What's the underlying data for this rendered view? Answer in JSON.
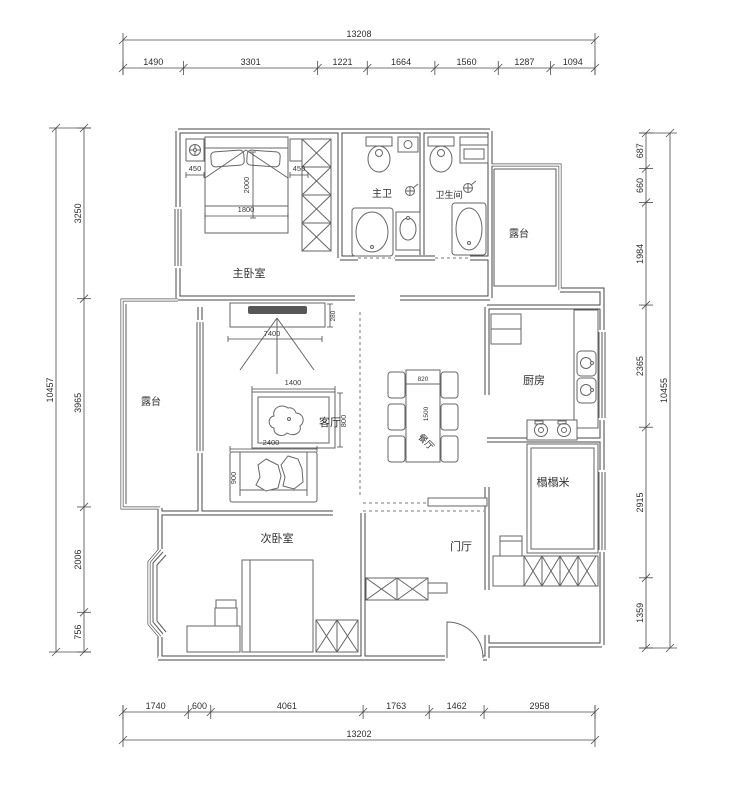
{
  "drawing": {
    "rooms": {
      "master_bedroom": "主卧室",
      "master_bath": "主卫",
      "bathroom": "卫生间",
      "terrace_top": "露台",
      "terrace_left": "露台",
      "living_room": "客厅",
      "dining_room": "餐厅",
      "kitchen": "厨房",
      "tatami_room": "榻榻米",
      "second_bedroom": "次卧室",
      "foyer": "门厅"
    },
    "furniture_dims": {
      "nightstand_left": "450",
      "nightstand_right": "450",
      "bed_width": "1800",
      "bed_length": "2000",
      "tv_wall_width": "7400",
      "tv_niche_depth": "280",
      "coffee_table_width": "1400",
      "coffee_table_depth": "800",
      "sofa_width": "2400",
      "sofa_depth": "900",
      "dining_table_width": "820",
      "dining_table_length": "1500"
    },
    "dimensions": {
      "top": {
        "total": "13208",
        "segments": [
          "1490",
          "3301",
          "1221",
          "1664",
          "1560",
          "1287",
          "1094"
        ]
      },
      "bottom": {
        "total": "13202",
        "segments": [
          "1740",
          "600",
          "4061",
          "1763",
          "1462",
          "2958"
        ]
      },
      "left": {
        "total": "10457",
        "segments": [
          "3250",
          "3965",
          "2006",
          "756"
        ]
      },
      "right": {
        "total": "10455",
        "segments": [
          "687",
          "660",
          "1984",
          "2365",
          "2915",
          "1359"
        ]
      }
    },
    "colors": {
      "background": "#ffffff",
      "walls": "#474747",
      "furniture_lines": "#666666",
      "text": "#2e2e2e"
    }
  }
}
